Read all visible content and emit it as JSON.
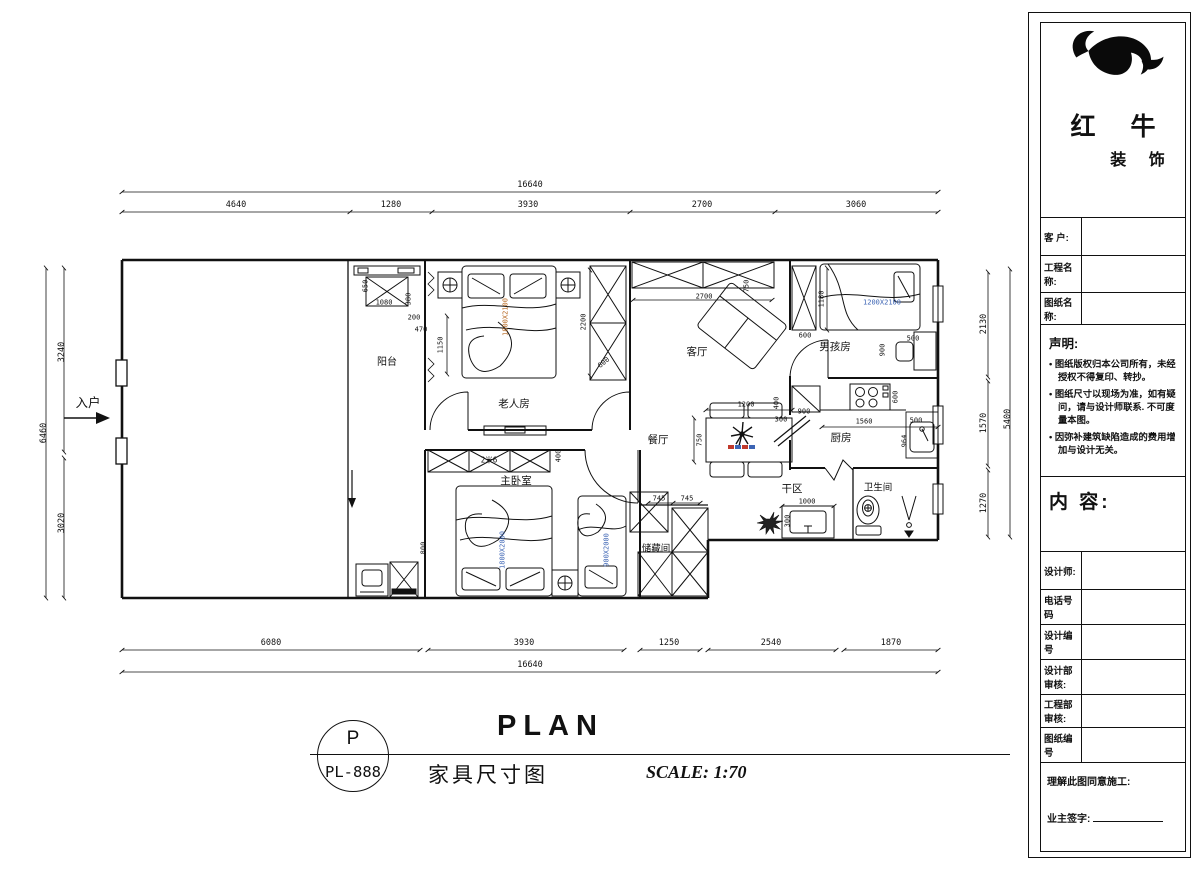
{
  "title_block": {
    "brand": {
      "name_top": "红 牛",
      "name_bottom": "装 饰"
    },
    "rows_top": [
      {
        "label": "客  户:",
        "value": ""
      },
      {
        "label": "工程名称:",
        "value": ""
      },
      {
        "label": "图纸名称:",
        "value": ""
      }
    ],
    "declaration": {
      "heading": "声明:",
      "items": [
        "图纸版权归本公司所有，未经授权不得复印、转抄。",
        "图纸尺寸以现场为准，如有疑问，请与设计师联系. 不可度量本图。",
        "因弥补建筑缺陷造成的费用增加与设计无关。"
      ]
    },
    "content_heading": "内 容:",
    "rows_bottom": [
      {
        "label": "设计师:",
        "value": ""
      },
      {
        "label": "电话号码",
        "value": ""
      },
      {
        "label": "设计编号",
        "value": ""
      },
      {
        "label": "设计部审核:",
        "value": ""
      },
      {
        "label": "工程部审核:",
        "value": ""
      },
      {
        "label": "图纸编号",
        "value": ""
      }
    ],
    "footer": {
      "line1": "理解此图同意施工:",
      "signature_label": "业主签字:"
    }
  },
  "title_bar": {
    "stamp_letter": "P",
    "stamp_code": "PL-888",
    "title": "PLAN",
    "subtitle": "家具尺寸图",
    "scale": "SCALE: 1:70"
  },
  "colors": {
    "line": "#111111",
    "bed_label_orange": "#b5651d",
    "bed_label_blue": "#3c64b4"
  },
  "plan": {
    "annotations": [
      {
        "n": "room-label-balcony",
        "t": "阳台",
        "x": 387,
        "y": 363,
        "s": 10
      },
      {
        "n": "room-label-elder-room",
        "t": "老人房",
        "x": 514,
        "y": 404,
        "s": 10.5
      },
      {
        "n": "room-label-living",
        "t": "客厅",
        "x": 697,
        "y": 352,
        "s": 10.5
      },
      {
        "n": "room-label-boy-room",
        "t": "男孩房",
        "x": 835,
        "y": 347,
        "s": 10.5
      },
      {
        "n": "room-label-dining",
        "t": "餐厅",
        "x": 658,
        "y": 440,
        "s": 10.5
      },
      {
        "n": "room-label-kitchen",
        "t": "厨房",
        "x": 841,
        "y": 438,
        "s": 10.5
      },
      {
        "n": "room-label-master",
        "t": "主卧室",
        "x": 516,
        "y": 481,
        "s": 10.5
      },
      {
        "n": "room-label-storage",
        "t": "储藏间",
        "x": 656,
        "y": 549,
        "s": 9.5
      },
      {
        "n": "room-label-dry-area",
        "t": "干区",
        "x": 792,
        "y": 489,
        "s": 10.5
      },
      {
        "n": "room-label-bathroom",
        "t": "卫生间",
        "x": 878,
        "y": 488,
        "s": 9.5
      },
      {
        "n": "entry-label",
        "t": "入户",
        "x": 88,
        "y": 403,
        "s": 12.5
      },
      {
        "n": "dim-top-overall",
        "t": "16640",
        "x": 530,
        "y": 185,
        "s": 8.5
      },
      {
        "n": "dim-top",
        "t": "4640",
        "x": 236,
        "y": 205,
        "s": 8.5
      },
      {
        "n": "dim-top",
        "t": "1280",
        "x": 391,
        "y": 205,
        "s": 8.5
      },
      {
        "n": "dim-top",
        "t": "3930",
        "x": 528,
        "y": 205,
        "s": 8.5
      },
      {
        "n": "dim-top",
        "t": "2700",
        "x": 702,
        "y": 205,
        "s": 8.5
      },
      {
        "n": "dim-top",
        "t": "3060",
        "x": 856,
        "y": 205,
        "s": 8.5
      },
      {
        "n": "dim-bottom",
        "t": "6080",
        "x": 271,
        "y": 643,
        "s": 8.5
      },
      {
        "n": "dim-bottom",
        "t": "3930",
        "x": 524,
        "y": 643,
        "s": 8.5
      },
      {
        "n": "dim-bottom",
        "t": "1250",
        "x": 669,
        "y": 643,
        "s": 8.5
      },
      {
        "n": "dim-bottom",
        "t": "2540",
        "x": 771,
        "y": 643,
        "s": 8.5
      },
      {
        "n": "dim-bottom",
        "t": "1870",
        "x": 891,
        "y": 643,
        "s": 8.5
      },
      {
        "n": "dim-bottom-overall",
        "t": "16640",
        "x": 530,
        "y": 665,
        "s": 8.5
      },
      {
        "n": "dim-left-overall",
        "t": "6460",
        "x": 44,
        "y": 433,
        "r": -90,
        "s": 8.5
      },
      {
        "n": "dim-left",
        "t": "3240",
        "x": 62,
        "y": 352,
        "r": -90,
        "s": 8.5
      },
      {
        "n": "dim-left",
        "t": "3020",
        "x": 62,
        "y": 523,
        "r": -90,
        "s": 8.5
      },
      {
        "n": "dim-right",
        "t": "2130",
        "x": 984,
        "y": 324,
        "r": -90,
        "s": 8.5
      },
      {
        "n": "dim-right",
        "t": "1570",
        "x": 984,
        "y": 423,
        "r": -90,
        "s": 8.5
      },
      {
        "n": "dim-right",
        "t": "1270",
        "x": 984,
        "y": 503,
        "r": -90,
        "s": 8.5
      },
      {
        "n": "dim-right-overall",
        "t": "5400",
        "x": 1008,
        "y": 419,
        "r": -90,
        "s": 8.5
      },
      {
        "n": "dim-int",
        "t": "650",
        "x": 366,
        "y": 286,
        "r": -90,
        "s": 7
      },
      {
        "n": "dim-int",
        "t": "1080",
        "x": 384,
        "y": 303,
        "s": 7
      },
      {
        "n": "dim-int",
        "t": "380",
        "x": 409,
        "y": 299,
        "r": -90,
        "s": 7
      },
      {
        "n": "dim-int",
        "t": "200",
        "x": 414,
        "y": 318,
        "s": 7
      },
      {
        "n": "dim-int",
        "t": "470",
        "x": 421,
        "y": 330,
        "s": 7
      },
      {
        "n": "dim-int",
        "t": "1150",
        "x": 441,
        "y": 345,
        "r": -90,
        "s": 7
      },
      {
        "n": "dim-int",
        "t": "2200",
        "x": 584,
        "y": 322,
        "r": -90,
        "s": 7
      },
      {
        "n": "dim-int",
        "t": "600",
        "x": 604,
        "y": 363,
        "r": -40,
        "s": 7
      },
      {
        "n": "dim-int",
        "t": "2700",
        "x": 704,
        "y": 297,
        "s": 7
      },
      {
        "n": "dim-int",
        "t": "750",
        "x": 747,
        "y": 286,
        "r": -90,
        "s": 7
      },
      {
        "n": "dim-int",
        "t": "600",
        "x": 805,
        "y": 336,
        "s": 7
      },
      {
        "n": "dim-int",
        "t": "1180",
        "x": 822,
        "y": 299,
        "r": -90,
        "s": 7
      },
      {
        "n": "dim-int",
        "t": "500",
        "x": 913,
        "y": 339,
        "s": 7
      },
      {
        "n": "dim-int",
        "t": "900",
        "x": 883,
        "y": 350,
        "r": -90,
        "s": 7
      },
      {
        "n": "dim-int",
        "t": "1200",
        "x": 746,
        "y": 405,
        "s": 7
      },
      {
        "n": "dim-int",
        "t": "750",
        "x": 700,
        "y": 440,
        "r": -90,
        "s": 7
      },
      {
        "n": "dim-int",
        "t": "900",
        "x": 804,
        "y": 412,
        "s": 7
      },
      {
        "n": "dim-int",
        "t": "400",
        "x": 777,
        "y": 403,
        "r": -90,
        "s": 7
      },
      {
        "n": "dim-int",
        "t": "300",
        "x": 781,
        "y": 420,
        "s": 7
      },
      {
        "n": "dim-int",
        "t": "1560",
        "x": 864,
        "y": 422,
        "s": 7
      },
      {
        "n": "dim-int",
        "t": "600",
        "x": 896,
        "y": 397,
        "r": -90,
        "s": 7
      },
      {
        "n": "dim-int",
        "t": "964",
        "x": 905,
        "y": 441,
        "r": -90,
        "s": 7
      },
      {
        "n": "dim-int",
        "t": "500",
        "x": 916,
        "y": 421,
        "s": 7
      },
      {
        "n": "dim-int",
        "t": "745",
        "x": 659,
        "y": 499,
        "s": 7
      },
      {
        "n": "dim-int",
        "t": "745",
        "x": 687,
        "y": 499,
        "s": 7
      },
      {
        "n": "dim-int",
        "t": "1000",
        "x": 807,
        "y": 502,
        "s": 7
      },
      {
        "n": "dim-int",
        "t": "300",
        "x": 788,
        "y": 521,
        "r": -90,
        "s": 7
      },
      {
        "n": "dim-int",
        "t": "800",
        "x": 424,
        "y": 548,
        "r": -90,
        "s": 7
      },
      {
        "n": "dim-int",
        "t": "400",
        "x": 559,
        "y": 456,
        "r": -90,
        "s": 7
      },
      {
        "n": "wardrobe-label",
        "t": "2米6",
        "x": 489,
        "y": 460,
        "s": 7.5
      },
      {
        "n": "bed-size-label",
        "t": "1800X2100",
        "x": 506,
        "y": 317,
        "r": -90,
        "c": "#b5651d",
        "s": 7
      },
      {
        "n": "bed-size-label",
        "t": "1200X2100",
        "x": 882,
        "y": 303,
        "c": "#3c64b4",
        "s": 7
      },
      {
        "n": "bed-size-label",
        "t": "1800X2000",
        "x": 503,
        "y": 550,
        "r": -90,
        "c": "#3c64b4",
        "s": 7
      },
      {
        "n": "bed-size-label",
        "t": "900X2000",
        "x": 607,
        "y": 550,
        "r": -90,
        "c": "#3c64b4",
        "s": 7
      }
    ]
  }
}
